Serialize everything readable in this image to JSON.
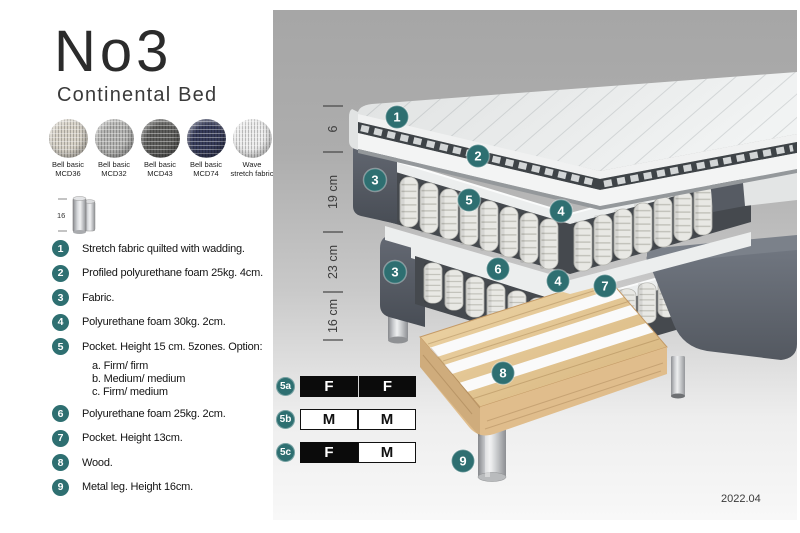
{
  "header": {
    "title": "No3",
    "subtitle": "Continental Bed"
  },
  "swatches": [
    {
      "line1": "Bell basic",
      "line2": "MCD36"
    },
    {
      "line1": "Bell basic",
      "line2": "MCD32"
    },
    {
      "line1": "Bell basic",
      "line2": "MCD43"
    },
    {
      "line1": "Bell basic",
      "line2": "MCD74"
    },
    {
      "line1": "Wave",
      "line2": "stretch fabric"
    }
  ],
  "leg_thumbnail": {
    "height_label": "16"
  },
  "materials": [
    {
      "num": "1",
      "text": "Stretch fabric quilted with wadding."
    },
    {
      "num": "2",
      "text": "Profiled polyurethane foam 25kg. 4cm."
    },
    {
      "num": "3",
      "text": "Fabric."
    },
    {
      "num": "4",
      "text": "Polyurethane foam 30kg. 2cm."
    },
    {
      "num": "5",
      "text": "Pocket. Height 15 cm. 5zones. Option:",
      "options": [
        "a. Firm/ firm",
        "b. Medium/ medium",
        "c. Firm/ medium"
      ]
    },
    {
      "num": "6",
      "text": "Polyurethane foam 25kg. 2cm."
    },
    {
      "num": "7",
      "text": "Pocket. Height 13cm."
    },
    {
      "num": "8",
      "text": "Wood."
    },
    {
      "num": "9",
      "text": "Metal leg. Height 16cm."
    }
  ],
  "diagram": {
    "dimension_labels": [
      "6",
      "19 cm",
      "23 cm",
      "16 cm"
    ],
    "callouts": [
      {
        "n": "1"
      },
      {
        "n": "2"
      },
      {
        "n": "4"
      },
      {
        "n": "3"
      },
      {
        "n": "5"
      },
      {
        "n": "4"
      },
      {
        "n": "6"
      },
      {
        "n": "7"
      },
      {
        "n": "3"
      },
      {
        "n": "8"
      },
      {
        "n": "9"
      }
    ],
    "version": "2022.04"
  },
  "firmness": {
    "rows": [
      {
        "label": "5a",
        "left": "F",
        "right": "F"
      },
      {
        "label": "5b",
        "left": "M",
        "right": "M"
      },
      {
        "label": "5c",
        "left": "F",
        "right": "M"
      }
    ]
  },
  "colors": {
    "accent_teal": "#2e6f71",
    "fabric_dark": "#565b63",
    "wood": "#e2c496",
    "metal": "#c7c9cc",
    "panel_gray_top": "#a6a6a6",
    "panel_gray_bottom": "#f8f8f8",
    "firmness_dark_cell": "#0b0b0b"
  }
}
